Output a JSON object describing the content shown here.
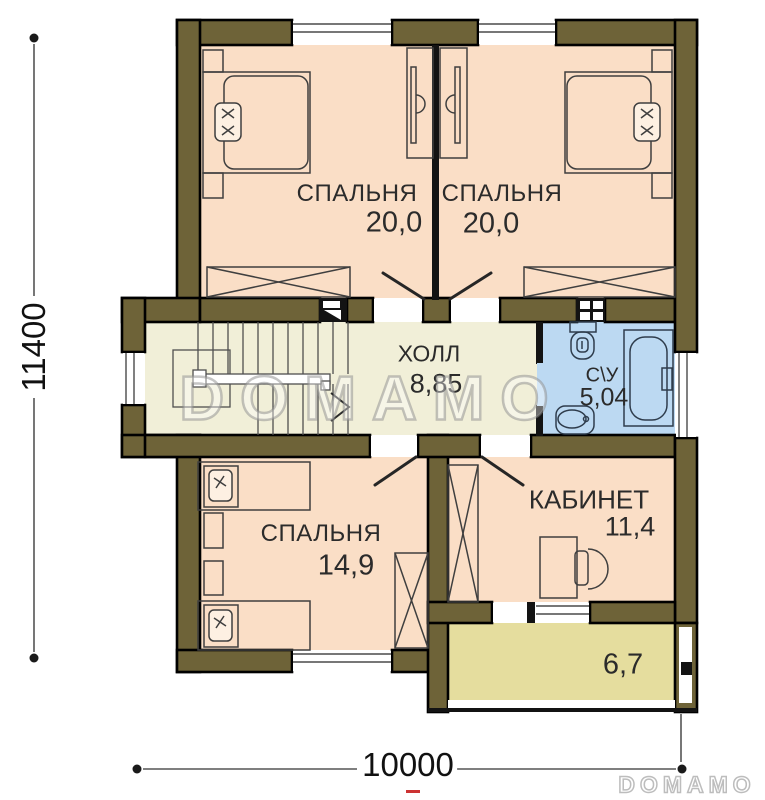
{
  "title": "Second floor plan",
  "rooms": [
    {
      "id": "bedroom-top-left",
      "label": "СПАЛЬНЯ",
      "area": "20,0"
    },
    {
      "id": "bedroom-top-right",
      "label": "СПАЛЬНЯ",
      "area": "20,0"
    },
    {
      "id": "hall",
      "label": "ХОЛЛ",
      "area": "8,85"
    },
    {
      "id": "bathroom",
      "label": "С\\У",
      "area": "5,04"
    },
    {
      "id": "bedroom-bottom",
      "label": "СПАЛЬНЯ",
      "area": "14,9"
    },
    {
      "id": "office",
      "label": "КАБИНЕТ",
      "area": "11,4"
    },
    {
      "id": "balcony",
      "label": "",
      "area": "6,7"
    }
  ],
  "dimensions": {
    "vertical": "11400",
    "horizontal": "10000"
  },
  "watermark": {
    "plan": "DOMAMO",
    "corner": "DOMAMO"
  },
  "symbols": {
    "vent_shaft": "vent-shaft-icon",
    "ventilation_grid": "ventilation-grid-icon",
    "stairs_direction": "stairs-direction-arrow"
  },
  "colors": {
    "wall": "#6e6338",
    "bedroom_floor": "#fadec6",
    "hall_floor": "#f1efd8",
    "bathroom_floor": "#bcd9f2",
    "balcony_floor": "#e5dd9e"
  }
}
